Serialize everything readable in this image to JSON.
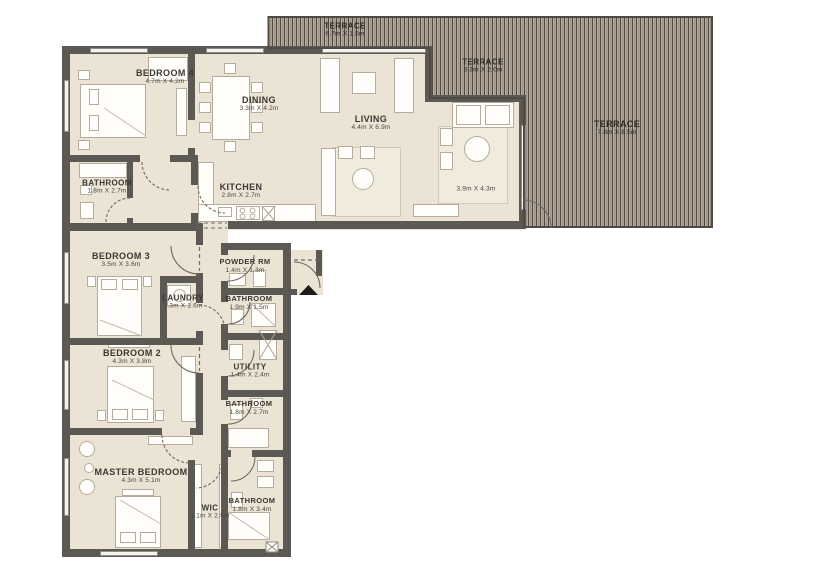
{
  "colors": {
    "floor": "#EBE3D3",
    "wall": "#5C5854",
    "terrace_stripe_dark": "#4E463D",
    "terrace_stripe_light": "#B5AB9D",
    "label_text": "#3B3733",
    "entry_marker": "#1E1C1A"
  },
  "rooms": {
    "terrace_top": {
      "name": "TERRACE",
      "dims": "6.7m X 1.5m"
    },
    "terrace_mid": {
      "name": "TERRACE",
      "dims": "3.3m X 2.0m"
    },
    "terrace_right": {
      "name": "TERRACE",
      "dims": "7.8m X 8.5m"
    },
    "bedroom4": {
      "name": "BEDROOM 4",
      "dims": "4.7m X 4.2m"
    },
    "dining": {
      "name": "DINING",
      "dims": "3.3m X 4.2m"
    },
    "living": {
      "name": "LIVING",
      "dims": "4.4m X 6.9m"
    },
    "living_area2": {
      "dims": "3.9m X 4.3m"
    },
    "bathroom_top": {
      "name": "BATHROOM",
      "dims": "1.8m X 2.7m"
    },
    "kitchen": {
      "name": "KITCHEN",
      "dims": "2.8m X 2.7m"
    },
    "bedroom3": {
      "name": "BEDROOM 3",
      "dims": "3.5m X 3.6m"
    },
    "laundry": {
      "name": "LAUNDRY",
      "dims": "1.3m X 1.6m"
    },
    "powder": {
      "name": "POWDER RM",
      "dims": "1.4m X 1.3m"
    },
    "bathroom_hall": {
      "name": "BATHROOM",
      "dims": "1.9m X 1.5m"
    },
    "bedroom2": {
      "name": "BEDROOM 2",
      "dims": "4.3m X 3.8m"
    },
    "utility": {
      "name": "UTILITY",
      "dims": "1.4m X 2.4m"
    },
    "bathroom_mid": {
      "name": "BATHROOM",
      "dims": "1.8m X 2.7m"
    },
    "master": {
      "name": "MASTER BEDROOM",
      "dims": "4.3m X 5.1m"
    },
    "wic": {
      "name": "WIC",
      "dims": "1.1m X 2.5m"
    },
    "bathroom_master": {
      "name": "BATHROOM",
      "dims": "1.8m X 3.4m"
    }
  }
}
